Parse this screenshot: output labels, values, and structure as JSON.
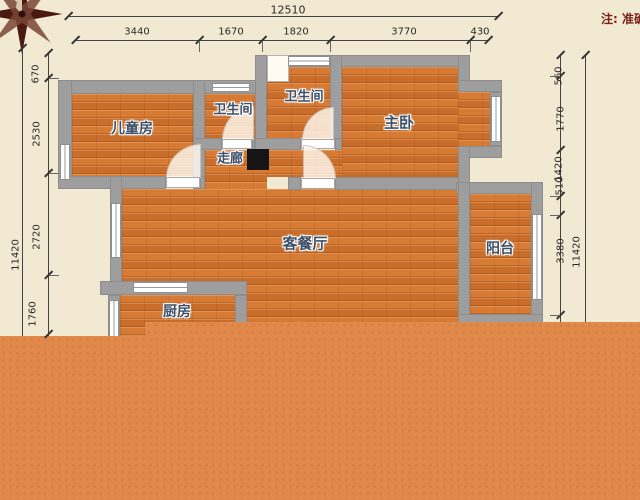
{
  "note": {
    "text": "注: 准确"
  },
  "compass": {
    "icon": "compass-rose-icon"
  },
  "rooms": [
    {
      "id": "children-room",
      "label": "儿童房"
    },
    {
      "id": "bathroom-1",
      "label": "卫生间"
    },
    {
      "id": "bathroom-2",
      "label": "卫生间"
    },
    {
      "id": "corridor",
      "label": "走廊"
    },
    {
      "id": "master-bedroom",
      "label": "主卧"
    },
    {
      "id": "living-dining",
      "label": "客餐厅"
    },
    {
      "id": "kitchen",
      "label": "厨房"
    },
    {
      "id": "balcony",
      "label": "阳台"
    }
  ],
  "dimensions": {
    "top": {
      "total": "12510",
      "segments": [
        "3440",
        "1670",
        "1820",
        "3770",
        "430"
      ]
    },
    "left": {
      "total": "11420",
      "segments": [
        "670",
        "2530",
        "2720",
        "1760"
      ]
    },
    "right": {
      "total": "11420",
      "segments": [
        "560",
        "1770",
        "1420",
        "510",
        "3380"
      ]
    }
  },
  "colors": {
    "background": "#f1e9d1",
    "floor_wood": "#d0742e",
    "wall": "#9e9e9e",
    "overlay_orange": "#e1894b",
    "dimension_text": "#2a2a2a",
    "room_label": "#3d5068",
    "note_text": "#7a2218",
    "compass": "#4a1a12"
  }
}
